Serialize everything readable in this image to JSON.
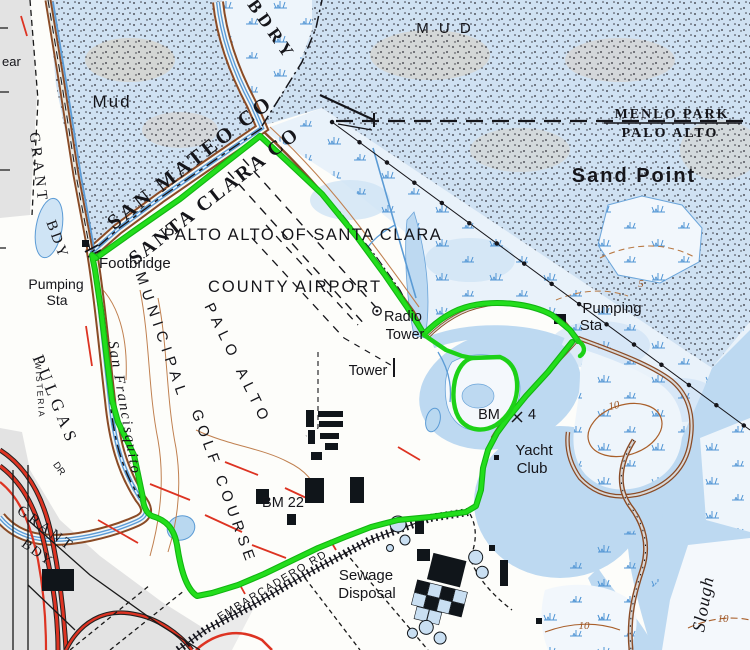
{
  "map": {
    "type": "usgs-topo-with-route-overlay",
    "area": "Palo Alto Baylands / Municipal Golf Course",
    "labels": {
      "ear": "ear",
      "mud_small": "Mud",
      "mud_large": "M U D",
      "bdry": "BDRY",
      "grant_top": "GRANT",
      "bdy_top": "BDY",
      "san_mateo_co": "SAN MATEO CO",
      "santa_clara_co": "SANTA CLARA CO",
      "menlo_park": "MENLO PARK",
      "palo_alto": "PALO ALTO",
      "sand_point": "Sand Point",
      "palto_alto_of_santa_clara": "PALTO ALTO OF SANTA CLARA",
      "county_airport": "COUNTY AIRPORT",
      "footbridge": "Footbridge",
      "pumping_left_1": "Pumping",
      "pumping_left_2": "Sta",
      "san_francisquito": "San Francisquito",
      "pulgas": "PULGAS",
      "wisteria": "WISTERIA",
      "dr": "DR",
      "grant_bottom": "GRANT",
      "bdy_bottom": "BDY",
      "municipal": "MUNICIPAL",
      "palo_alto_golf": "PALO ALTO",
      "golf_course": "GOLF COURSE",
      "radio_1": "Radio",
      "radio_2": "Tower",
      "tower": "Tower",
      "pumping_right_1": "Pumping",
      "pumping_right_2": "Sta",
      "bm4_bm": "BM",
      "bm4_4": "4",
      "yacht_1": "Yacht",
      "yacht_2": "Club",
      "bm22": "BM 22",
      "embarcadero": "EMBARCADERO  RD",
      "sewage_1": "Sewage",
      "sewage_2": "Disposal",
      "slough": "Slough",
      "contour_5": "5",
      "contour_10_a": "10",
      "contour_10_b": "10",
      "contour_10_c": "10"
    },
    "colors": {
      "route_green": "#1dd117",
      "water_blue": "#bdd9f1",
      "marsh_tuft_blue": "#4f94d4",
      "levee_brown": "#8a4b26",
      "contour_brown": "#a95f2a",
      "road_red": "#dd3322",
      "stipple_base": "#cfe1f2",
      "urban_gray": "#e3e3e3",
      "ink_black": "#15151a"
    },
    "symbols": {
      "radio_tower": "circle-dot-icon",
      "benchmark_bm4": "x-cross-icon",
      "footbridge": "double-bar-icon",
      "power_line": "line-with-pole-dots",
      "embankment_road": "hatched-band",
      "marsh": "grass-tuft-icon",
      "mud_flat": "stipple-dots"
    }
  }
}
